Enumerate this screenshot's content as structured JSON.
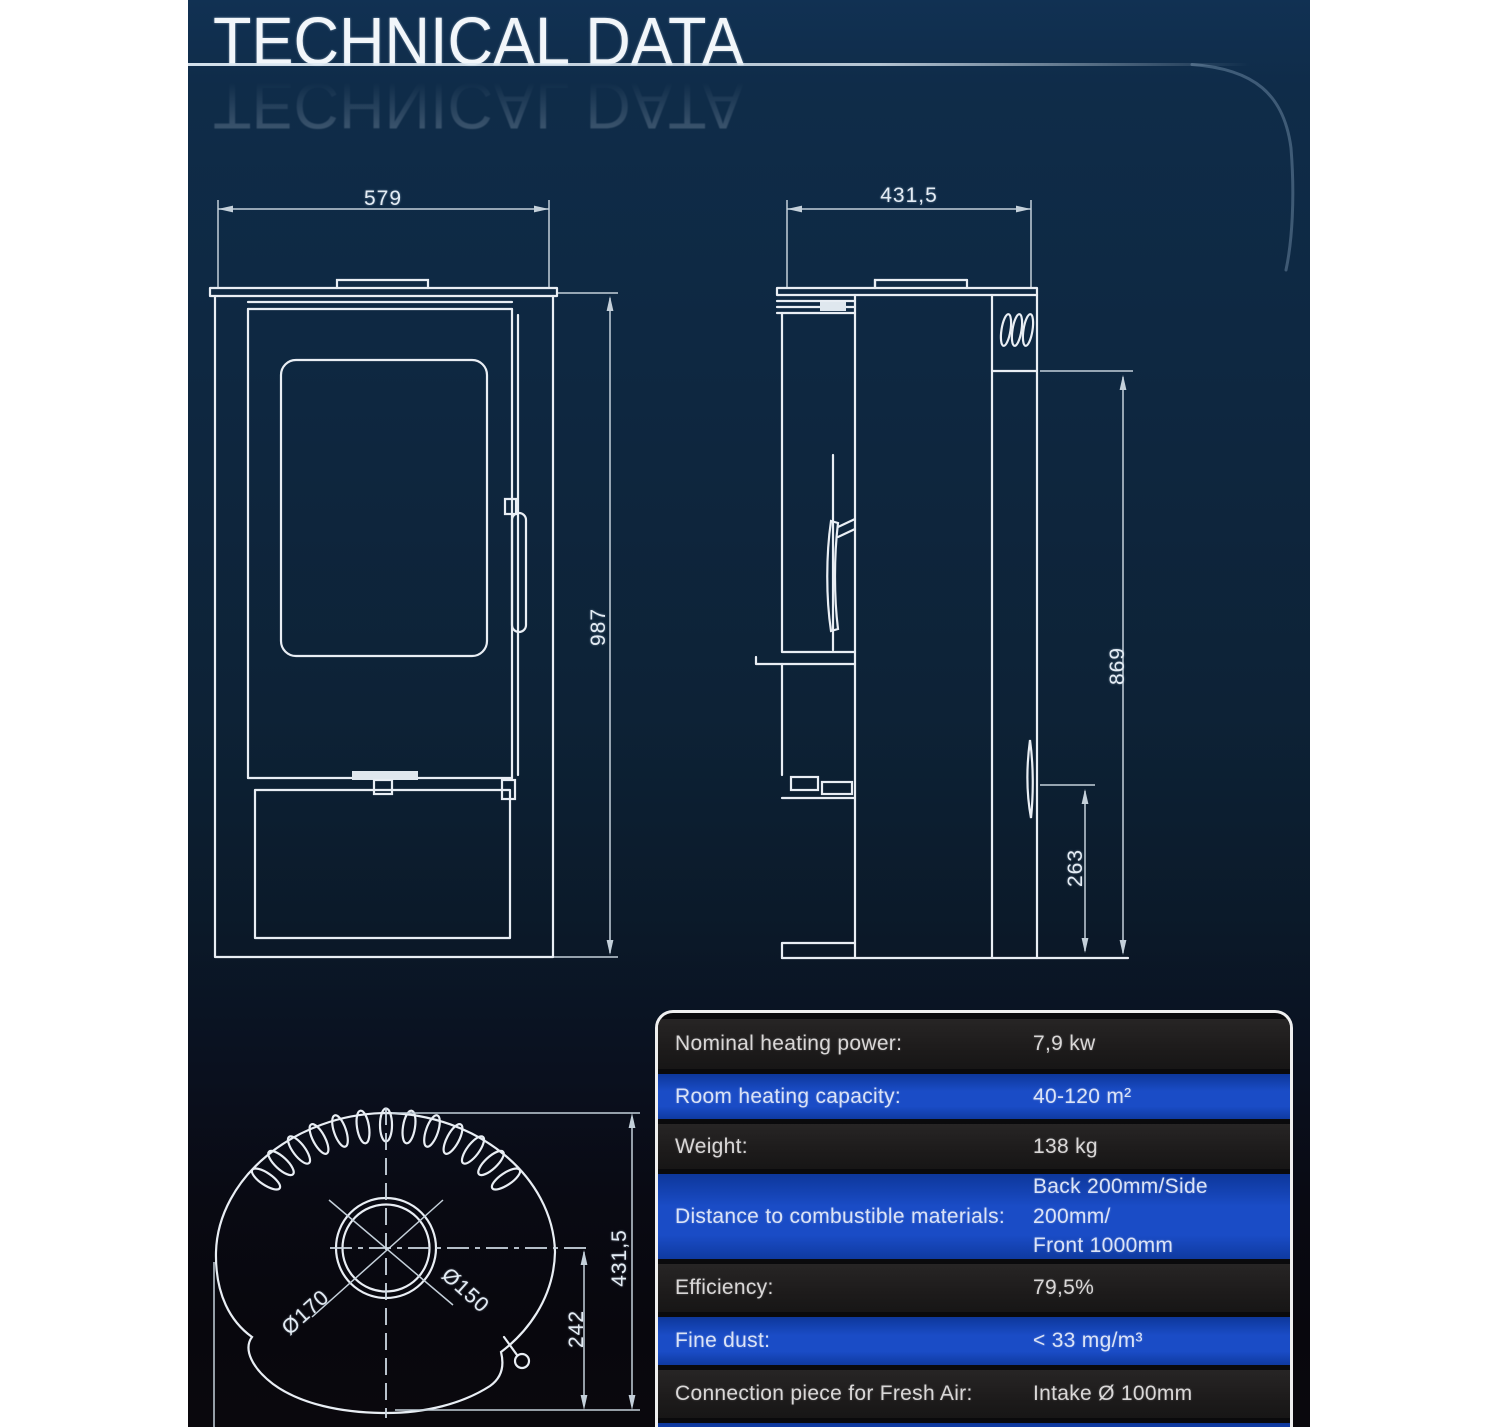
{
  "header": {
    "title": "TECHNICAL DATA"
  },
  "views": {
    "front": {
      "width": "579",
      "height": "987"
    },
    "side": {
      "depth": "431,5",
      "height": "869",
      "base_height": "263"
    },
    "top": {
      "collar_outer": "Ø170",
      "collar_inner": "Ø150",
      "center_offset": "242",
      "depth": "431,5"
    }
  },
  "spec_table": {
    "rows": [
      {
        "label": "Nominal heating power:",
        "value": "7,9 kw"
      },
      {
        "label": "Room heating capacity:",
        "value": "40-120 m²"
      },
      {
        "label": "Weight:",
        "value": "138 kg"
      },
      {
        "label": "Distance to combustible materials:",
        "value": "Back 200mm/Side 200mm/",
        "value2": "Front 1000mm"
      },
      {
        "label": "Efficiency:",
        "value": "79,5%"
      },
      {
        "label": "Fine dust:",
        "value": "< 33 mg/m³"
      },
      {
        "label": "Connection piece for Fresh Air:",
        "value": "Intake Ø 100mm"
      }
    ]
  },
  "colors": {
    "row_blue": "#1a4cc6",
    "row_dark": "#1f1e1e",
    "panel_navy": "#0e2740",
    "line_white": "#e9eef4"
  }
}
